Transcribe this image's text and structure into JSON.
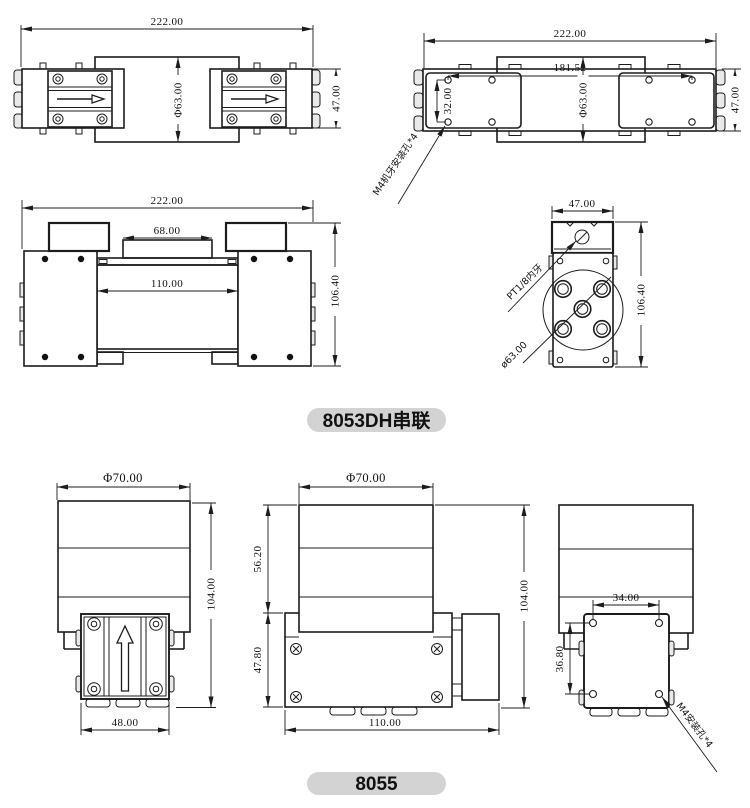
{
  "doc": {
    "background": "#ffffff",
    "line_color": "#1c1c1c",
    "pill_color": "#d3d3d3"
  },
  "sections": [
    {
      "title": "8053DH串联",
      "views": {
        "top": {
          "overall_width": "222.00",
          "motor_diameter": "Φ63.00",
          "head_height": "47.00"
        },
        "bottom": {
          "overall_width": "222.00",
          "hole_span": "181.52",
          "motor_diameter": "Φ63.00",
          "hole_offset": "32.00",
          "body_height": "47.00",
          "mount_callout": "M4机牙安装孔*4"
        },
        "front": {
          "overall_width": "222.00",
          "top_width": "68.00",
          "body_width": "110.00",
          "overall_height": "106.40"
        },
        "side": {
          "width": "47.00",
          "height": "106.40",
          "port_callout": "PT1/8内牙",
          "diameter_callout": "ø63.00"
        }
      }
    },
    {
      "title": "8055",
      "views": {
        "front": {
          "motor_diameter": "Φ70.00",
          "overall_height": "104.00",
          "head_width": "48.00"
        },
        "side": {
          "motor_diameter": "Φ70.00",
          "motor_height": "56.20",
          "body_height": "47.80",
          "overall_height": "104.00",
          "body_width": "110.00"
        },
        "rear": {
          "hole_span_width": "34.00",
          "hole_span_height": "36.80",
          "mount_callout": "M4安装孔*4"
        }
      }
    }
  ]
}
